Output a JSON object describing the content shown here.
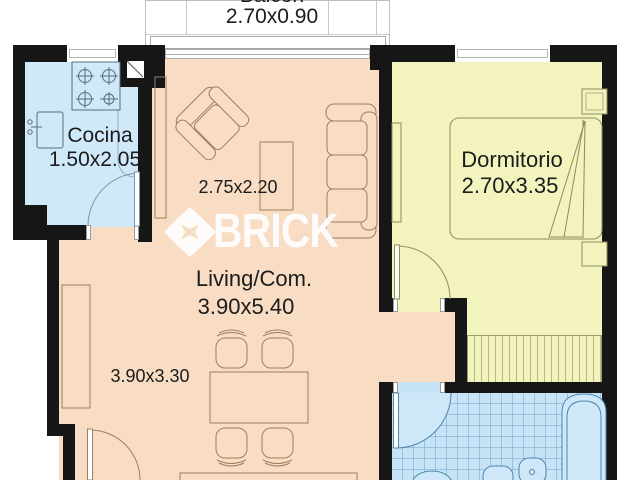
{
  "plan_title": "Apartment floor plan",
  "watermark": {
    "brand": "BRICK"
  },
  "rooms": {
    "balcony": {
      "name": "Balcón",
      "dimensions": "2.70x0.90"
    },
    "kitchen": {
      "name": "Cocina",
      "dimensions": "1.50x2.05"
    },
    "living": {
      "name": "Living/Com.",
      "dimensions": "3.90x5.40",
      "sub_area_upper": "2.75x2.20",
      "sub_area_lower": "3.90x3.30"
    },
    "bedroom": {
      "name": "Dormitorio",
      "dimensions": "2.70x3.35"
    }
  },
  "colors": {
    "living_floor": "#f8dcc3",
    "kitchen_floor": "#cfe9f8",
    "bathroom_floor": "#c6e4f6",
    "bedroom_floor": "#f3f3bd",
    "walls": "#161616",
    "watermark": "#ffffff"
  }
}
